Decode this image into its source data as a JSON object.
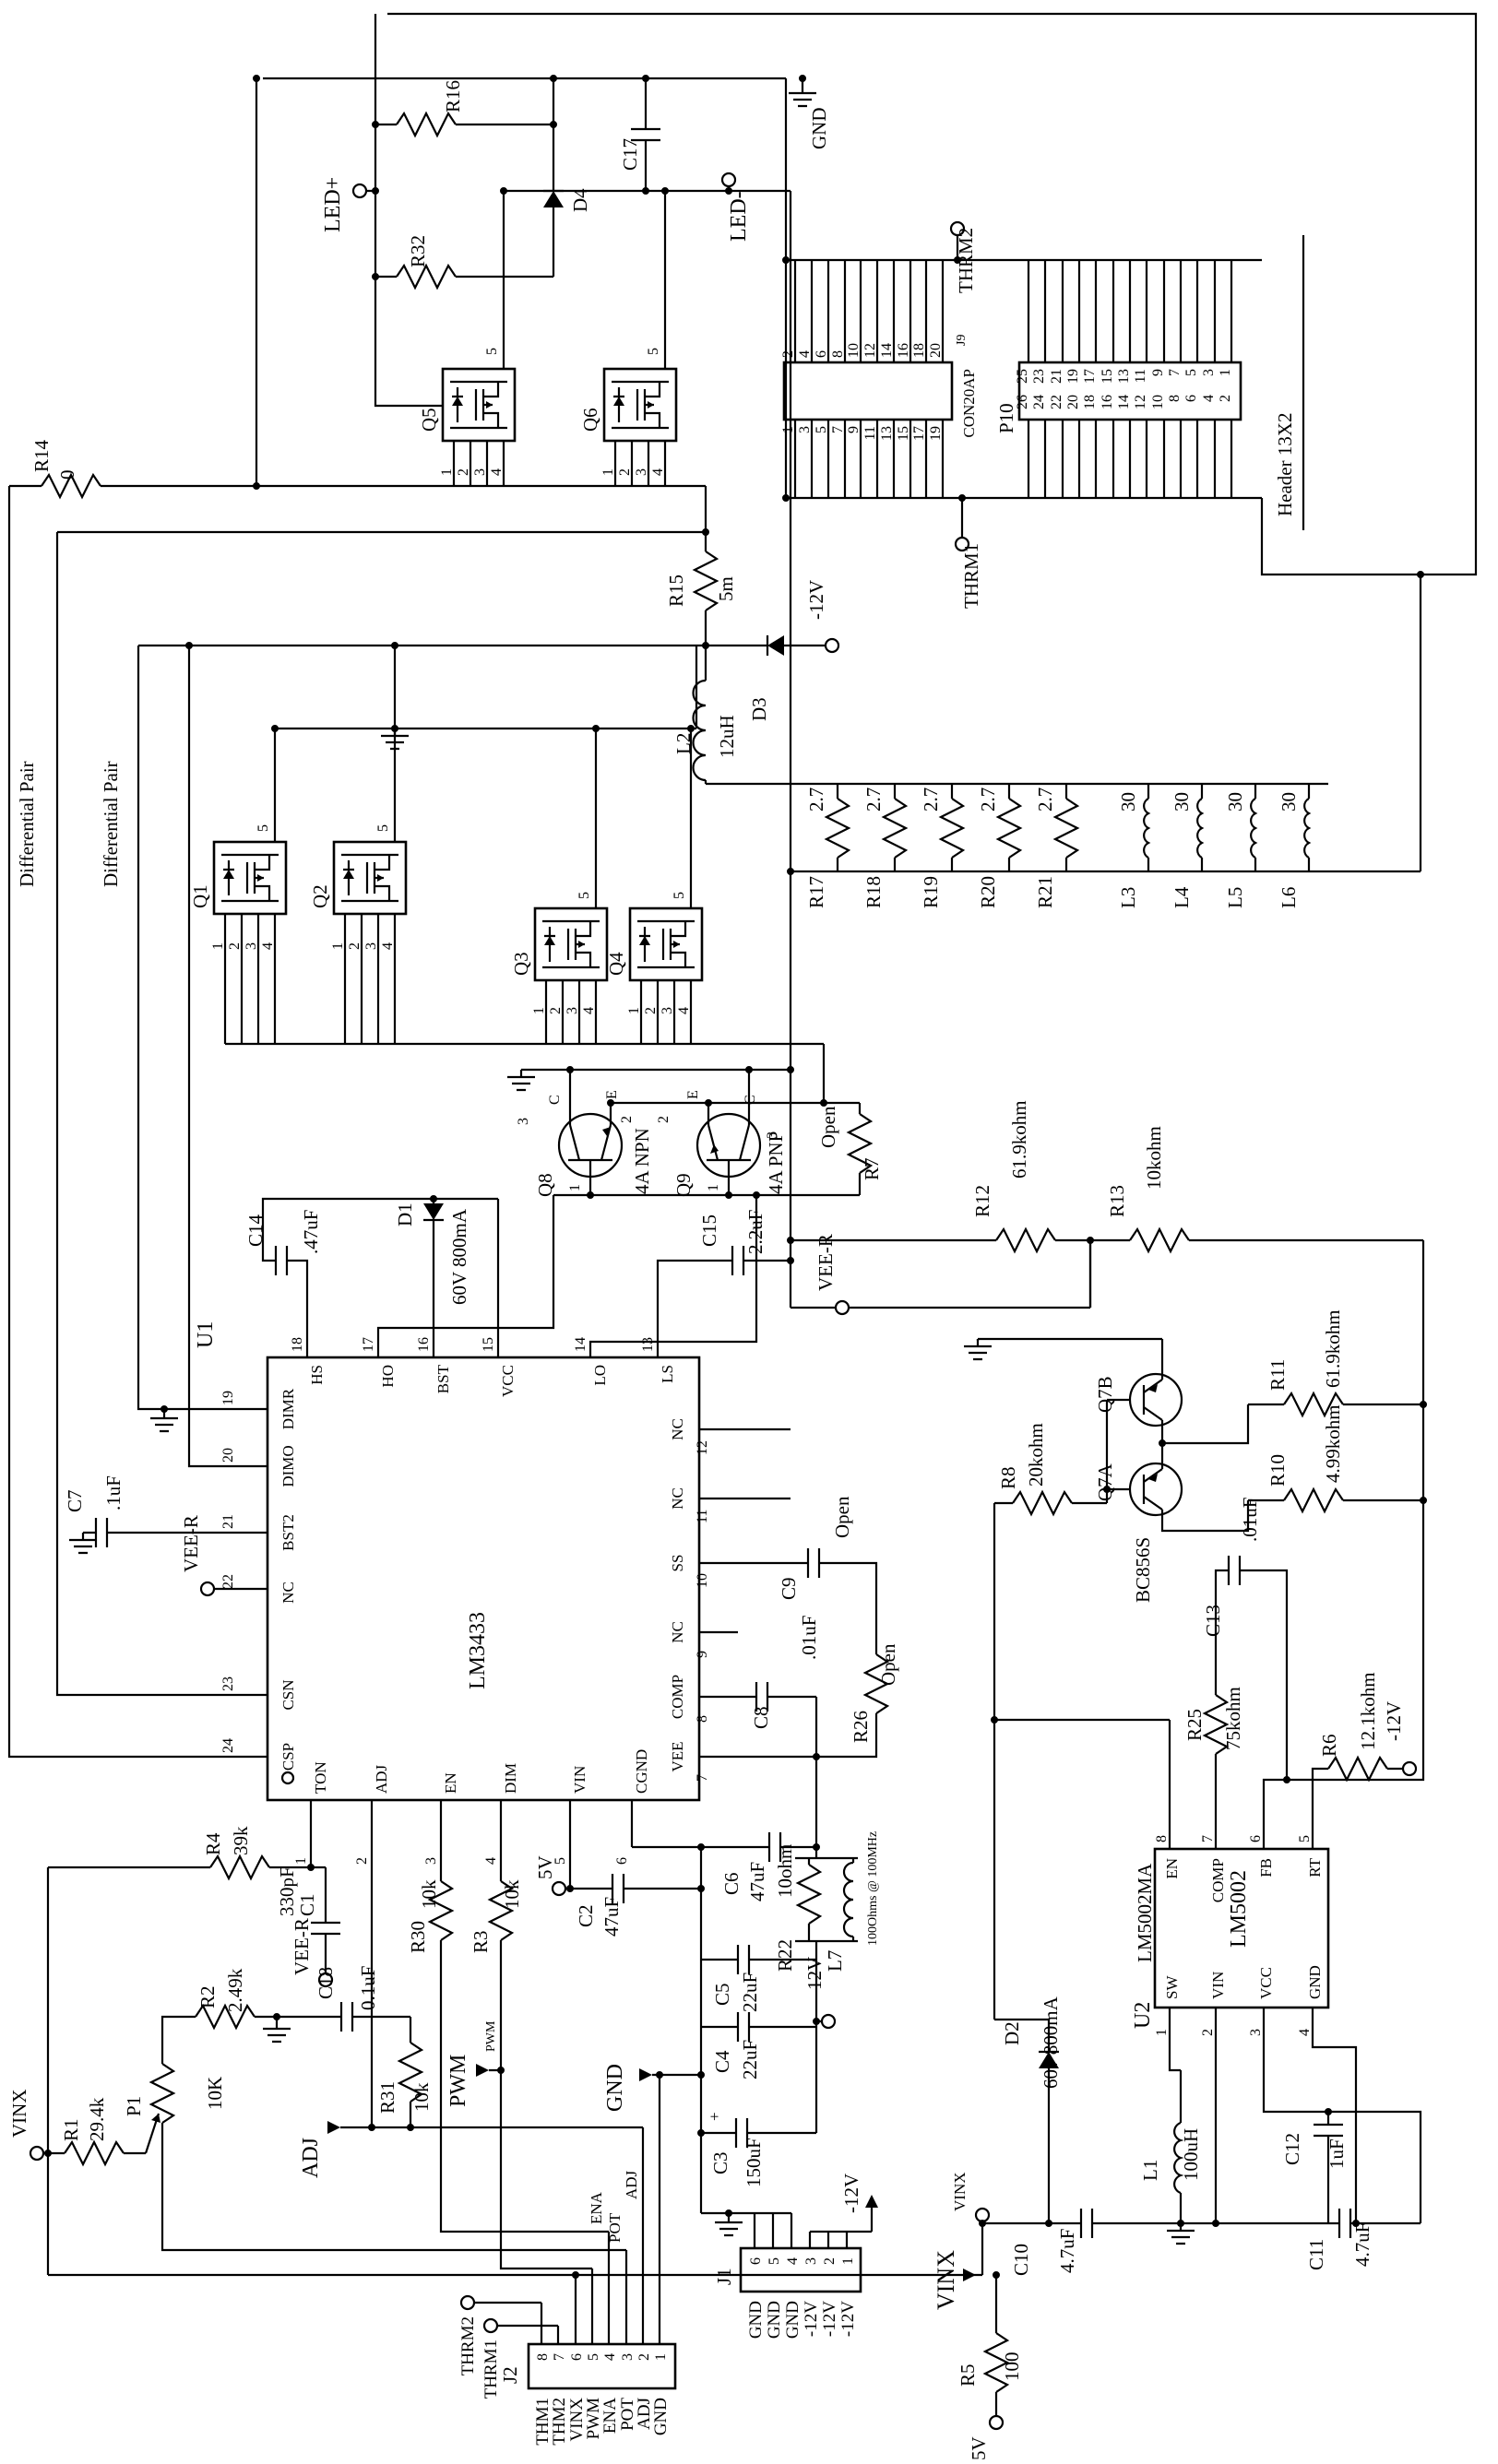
{
  "nums": {
    "n1": "1",
    "n2": "2",
    "n3": "3",
    "n4": "4",
    "n5": "5",
    "n6": "6",
    "n7": "7",
    "n8": "8",
    "n9": "9",
    "n10": "10",
    "n11": "11",
    "n12": "12",
    "n13": "13",
    "n14": "14",
    "n15": "15",
    "n16": "16",
    "n17": "17",
    "n18": "18",
    "n19": "19",
    "n20": "20",
    "n21": "21",
    "n22": "22",
    "n23": "23",
    "n24": "24",
    "n25": "25",
    "n26": "26"
  },
  "parts": {
    "r1": {
      "ref": "R1",
      "val": "29.4k"
    },
    "r2": {
      "ref": "R2",
      "val": "2.49k"
    },
    "r3": {
      "ref": "R3",
      "val": "10k"
    },
    "r4": {
      "ref": "R4",
      "val": "39k"
    },
    "r5": {
      "ref": "R5",
      "val": "100"
    },
    "r6": {
      "ref": "R6",
      "val": "12.1kohm"
    },
    "r7": {
      "ref": "R7",
      "val": "Open"
    },
    "r8": {
      "ref": "R8",
      "val": "20kohm"
    },
    "r10": {
      "ref": "R10",
      "val": "4.99kohm"
    },
    "r11": {
      "ref": "R11",
      "val": "61.9kohm"
    },
    "r12": {
      "ref": "R12",
      "val": "61.9kohm"
    },
    "r13": {
      "ref": "R13",
      "val": "10kohm"
    },
    "r14": {
      "ref": "R14",
      "val": "0"
    },
    "r15": {
      "ref": "R15",
      "val": "5m"
    },
    "r16": {
      "ref": "R16"
    },
    "r17": {
      "ref": "R17",
      "val": "2.7"
    },
    "r18": {
      "ref": "R18",
      "val": "2.7"
    },
    "r19": {
      "ref": "R19",
      "val": "2.7"
    },
    "r20": {
      "ref": "R20",
      "val": "2.7"
    },
    "r21": {
      "ref": "R21",
      "val": "2.7"
    },
    "r22": {
      "ref": "R22",
      "val": "10ohm"
    },
    "r25": {
      "ref": "R25",
      "val": "75kohm"
    },
    "r26": {
      "ref": "R26",
      "val": "Open"
    },
    "r30": {
      "ref": "R30",
      "val": "10k"
    },
    "r31": {
      "ref": "R31",
      "val": "10k"
    },
    "r32": {
      "ref": "R32"
    },
    "p1": {
      "ref": "P1",
      "val": "10K"
    },
    "c1": {
      "ref": "C1",
      "val": "330pF"
    },
    "c2": {
      "ref": "C2",
      "val": "47uF"
    },
    "c3": {
      "ref": "C3",
      "val": "150uF"
    },
    "c4": {
      "ref": "C4",
      "val": "22uF"
    },
    "c5": {
      "ref": "C5",
      "val": "22uF"
    },
    "c6": {
      "ref": "C6",
      "val": "47uF"
    },
    "c7": {
      "ref": "C7",
      "val": ".1uF"
    },
    "c8": {
      "ref": "C8",
      "val": ".01uF"
    },
    "c9": {
      "ref": "C9",
      "val": "Open"
    },
    "c10": {
      "ref": "C10",
      "val": "4.7uF"
    },
    "c11": {
      "ref": "C11",
      "val": "4.7uF"
    },
    "c12": {
      "ref": "C12",
      "val": "1uF"
    },
    "c13": {
      "ref": "C13",
      "val": ".01uF"
    },
    "c14": {
      "ref": "C14",
      "val": ".47uF"
    },
    "c15": {
      "ref": "C15",
      "val": "2.2uF"
    },
    "c17": {
      "ref": "C17"
    },
    "c18": {
      "ref": "C18",
      "val": "0.1uF"
    },
    "l1": {
      "ref": "L1",
      "val": "100uH"
    },
    "l2": {
      "ref": "L2",
      "val": "12uH"
    },
    "l3": {
      "ref": "L3",
      "val": "30"
    },
    "l4": {
      "ref": "L4",
      "val": "30"
    },
    "l5": {
      "ref": "L5",
      "val": "30"
    },
    "l6": {
      "ref": "L6",
      "val": "30"
    },
    "l7": {
      "ref": "L7",
      "val": "100Ohms @ 100MHz"
    },
    "d1": {
      "ref": "D1",
      "val": "60V 800mA"
    },
    "d2": {
      "ref": "D2",
      "val": "60v 800mA"
    },
    "d3": {
      "ref": "D3"
    },
    "d4": {
      "ref": "D4"
    },
    "q1": {
      "ref": "Q1"
    },
    "q2": {
      "ref": "Q2"
    },
    "q3": {
      "ref": "Q3"
    },
    "q4": {
      "ref": "Q4"
    },
    "q5": {
      "ref": "Q5"
    },
    "q6": {
      "ref": "Q6"
    },
    "q7a": {
      "ref": "Q7A",
      "val": "BC856S"
    },
    "q7b": {
      "ref": "Q7B"
    },
    "q8": {
      "ref": "Q8",
      "val": "4A NPN"
    },
    "q9": {
      "ref": "Q9",
      "val": "4A PNP"
    }
  },
  "u1": {
    "ref": "U1",
    "part": "LM3433",
    "pin_names": {
      "p1": "TON",
      "p2": "ADJ",
      "p3": "EN",
      "p4": "DIM",
      "p5": "VIN",
      "p6": "CGND",
      "p7": "VEE",
      "p8": "COMP",
      "p9": "NC",
      "p10": "SS",
      "p11": "NC",
      "p12": "NC",
      "p13": "LS",
      "p14": "LO",
      "p15": "VCC",
      "p16": "BST",
      "p17": "HO",
      "p18": "HS",
      "p19": "DIMR",
      "p20": "DIMO",
      "p21": "BST2",
      "p22": "NC",
      "p23": "CSN",
      "p24": "CSP"
    }
  },
  "u2": {
    "ref": "U2",
    "part": "LM5002",
    "variant": "LM5002MA",
    "pin_names": {
      "p1": "SW",
      "p2": "VIN",
      "p3": "VCC",
      "p4": "GND",
      "p5": "RT",
      "p6": "FB",
      "p7": "COMP",
      "p8": "EN"
    }
  },
  "j9": {
    "ref": "J9",
    "name": "CON20AP"
  },
  "p10": {
    "ref": "P10",
    "name": "Header 13X2"
  },
  "j2": {
    "ref": "J2",
    "signals": {
      "s1": "GND",
      "s2": "ADJ",
      "s3": "POT",
      "s4": "ENA",
      "s5": "PWM",
      "s6": "VINX",
      "s7": "THM2",
      "s8": "THM1"
    }
  },
  "j1": {
    "ref": "J1",
    "signals": {
      "s1": "-12V",
      "s2": "-12V",
      "s3": "-12V",
      "s4": "GND",
      "s5": "GND",
      "s6": "GND"
    }
  },
  "ports": {
    "led_plus": "LED+",
    "led_minus": "LED-",
    "gnd": "GND",
    "thrm1": "THRM1",
    "thrm2": "THRM2",
    "vee_r": "VEE-R",
    "minus12v": "-12V",
    "plus5v": "5V",
    "vinx": "VINX",
    "pwm": "PWM",
    "adj": "ADJ"
  },
  "nets": {
    "pwm": "PWM",
    "ena": "ENA",
    "pot": "POT",
    "adj": "ADJ"
  },
  "notes": {
    "diff_pair": "Differential Pair"
  },
  "tx": {
    "c": "C",
    "e": "E"
  },
  "sym": {
    "plus": "+"
  }
}
